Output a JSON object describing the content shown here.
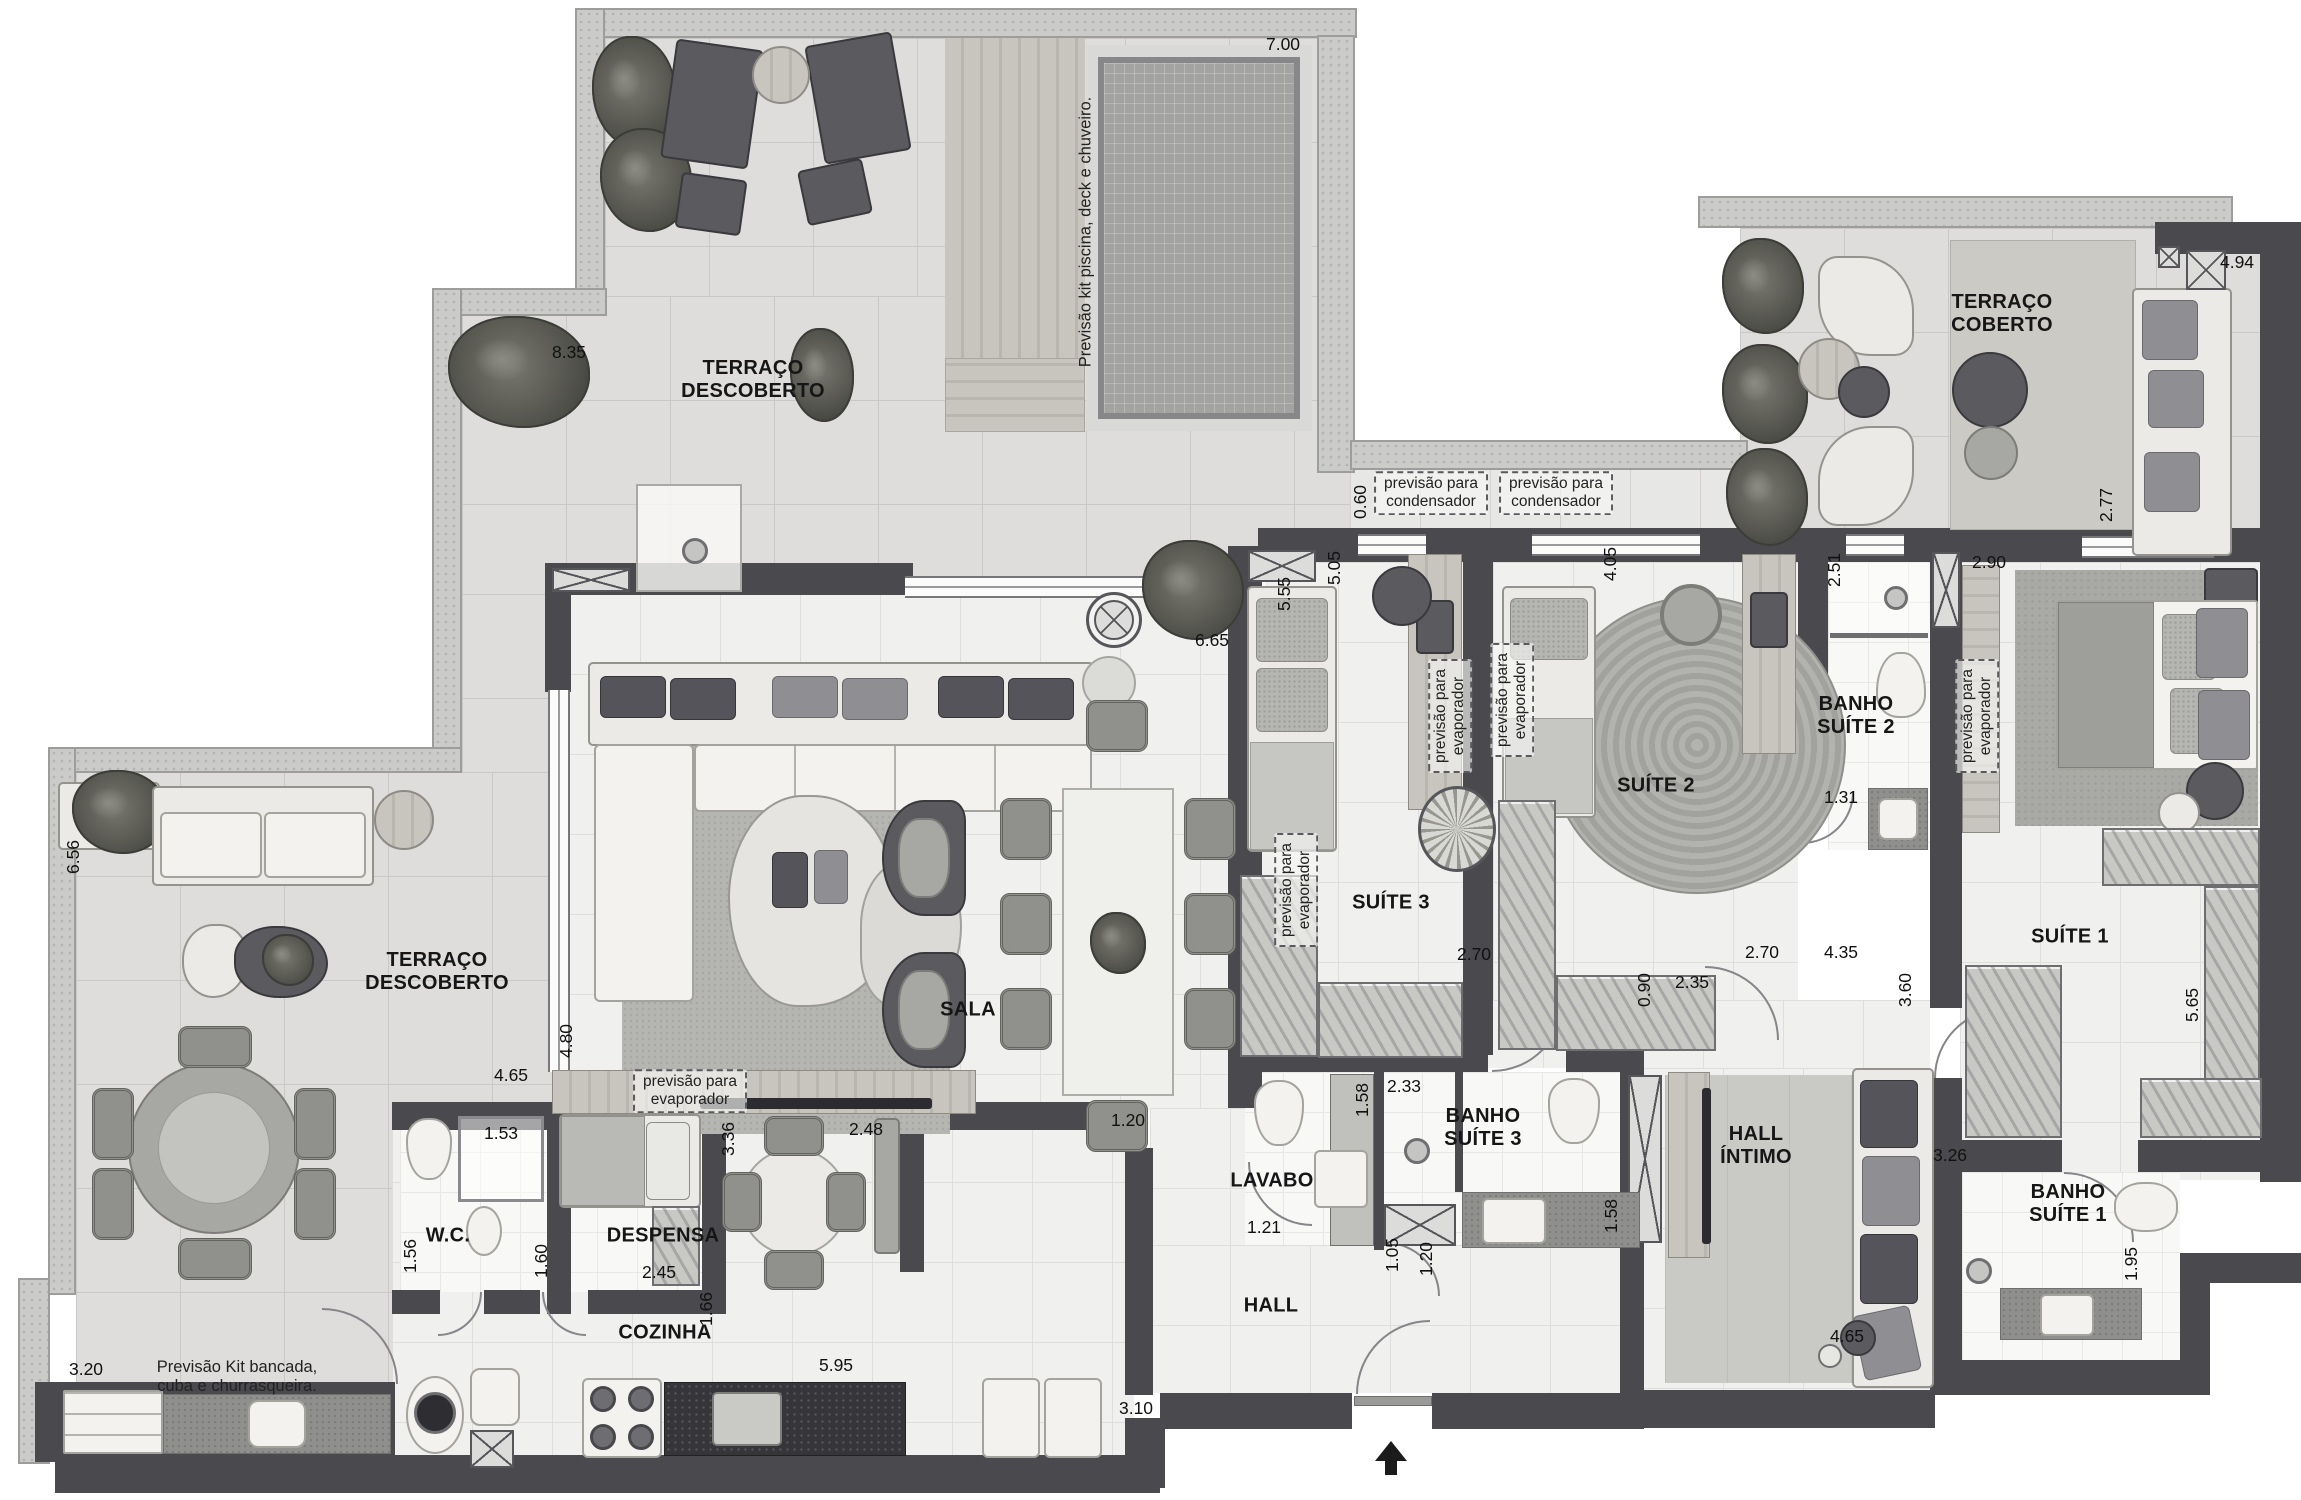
{
  "colors": {
    "wall": "#4a4a4e",
    "floor_tile": "#dedddb",
    "interior_tile": "#f0f0ee",
    "pool_water": "#a3a3a1",
    "annotation_ink": "#222222"
  },
  "floorplan": {
    "room_labels": [
      {
        "name": "room-label-terraco-descoberto-top",
        "text": "TERRAÇO\nDESCOBERTO",
        "x": 753,
        "y": 380
      },
      {
        "name": "room-label-terraco-coberto",
        "text": "TERRAÇO\nCOBERTO",
        "x": 2002,
        "y": 314
      },
      {
        "name": "room-label-terraco-descoberto-left",
        "text": "TERRAÇO\nDESCOBERTO",
        "x": 437,
        "y": 972
      },
      {
        "name": "room-label-sala",
        "text": "SALA",
        "x": 968,
        "y": 1010
      },
      {
        "name": "room-label-cozinha",
        "text": "COZINHA",
        "x": 665,
        "y": 1333
      },
      {
        "name": "room-label-despensa",
        "text": "DESPENSA",
        "x": 663,
        "y": 1236
      },
      {
        "name": "room-label-wc",
        "text": "W.C.",
        "x": 448,
        "y": 1236
      },
      {
        "name": "room-label-lavabo",
        "text": "LAVABO",
        "x": 1272,
        "y": 1181
      },
      {
        "name": "room-label-hall",
        "text": "HALL",
        "x": 1271,
        "y": 1306
      },
      {
        "name": "room-label-hall-intimo",
        "text": "HALL\nÍNTIMO",
        "x": 1756,
        "y": 1146
      },
      {
        "name": "room-label-banho-suite-3",
        "text": "BANHO\nSUÍTE 3",
        "x": 1483,
        "y": 1128
      },
      {
        "name": "room-label-banho-suite-2",
        "text": "BANHO\nSUÍTE 2",
        "x": 1856,
        "y": 716
      },
      {
        "name": "room-label-banho-suite-1",
        "text": "BANHO\nSUÍTE 1",
        "x": 2068,
        "y": 1204
      },
      {
        "name": "room-label-suite-1",
        "text": "SUÍTE 1",
        "x": 2070,
        "y": 937
      },
      {
        "name": "room-label-suite-2",
        "text": "SUÍTE 2",
        "x": 1656,
        "y": 786
      },
      {
        "name": "room-label-suite-3",
        "text": "SUÍTE 3",
        "x": 1391,
        "y": 903
      }
    ],
    "dimensions": [
      {
        "text": "7.00",
        "x": 1283,
        "y": 44,
        "rot": 0
      },
      {
        "text": "8.35",
        "x": 569,
        "y": 352,
        "rot": 0
      },
      {
        "text": "4.94",
        "x": 2237,
        "y": 262,
        "rot": 0
      },
      {
        "text": "2.77",
        "x": 2106,
        "y": 505,
        "rot": -90
      },
      {
        "text": "0.60",
        "x": 1360,
        "y": 502,
        "rot": -90
      },
      {
        "text": "6.56",
        "x": 73,
        "y": 857,
        "rot": -90
      },
      {
        "text": "3.20",
        "x": 86,
        "y": 1369,
        "rot": 0
      },
      {
        "text": "5.55",
        "x": 1284,
        "y": 594,
        "rot": -90
      },
      {
        "text": "6.65",
        "x": 1212,
        "y": 640,
        "rot": 0
      },
      {
        "text": "4.80",
        "x": 566,
        "y": 1041,
        "rot": -90
      },
      {
        "text": "4.65",
        "x": 511,
        "y": 1075,
        "rot": 0
      },
      {
        "text": "5.05",
        "x": 1334,
        "y": 568,
        "rot": -90
      },
      {
        "text": "4.05",
        "x": 1610,
        "y": 564,
        "rot": -90
      },
      {
        "text": "2.51",
        "x": 1834,
        "y": 570,
        "rot": -90
      },
      {
        "text": "2.90",
        "x": 1989,
        "y": 562,
        "rot": 0
      },
      {
        "text": "1.31",
        "x": 1841,
        "y": 797,
        "rot": 0
      },
      {
        "text": "2.70",
        "x": 1474,
        "y": 954,
        "rot": 0
      },
      {
        "text": "2.70",
        "x": 1762,
        "y": 952,
        "rot": 0
      },
      {
        "text": "4.35",
        "x": 1841,
        "y": 952,
        "rot": 0
      },
      {
        "text": "2.35",
        "x": 1692,
        "y": 982,
        "rot": 0
      },
      {
        "text": "0.90",
        "x": 1644,
        "y": 990,
        "rot": -90
      },
      {
        "text": "3.60",
        "x": 1905,
        "y": 990,
        "rot": -90
      },
      {
        "text": "5.65",
        "x": 2192,
        "y": 1005,
        "rot": -90
      },
      {
        "text": "3.26",
        "x": 1950,
        "y": 1155,
        "rot": 0
      },
      {
        "text": "1.95",
        "x": 2131,
        "y": 1264,
        "rot": -90
      },
      {
        "text": "4.65",
        "x": 1847,
        "y": 1336,
        "rot": 0
      },
      {
        "text": "1.58",
        "x": 1362,
        "y": 1100,
        "rot": -90
      },
      {
        "text": "2.33",
        "x": 1404,
        "y": 1086,
        "rot": 0
      },
      {
        "text": "1.58",
        "x": 1611,
        "y": 1216,
        "rot": -90
      },
      {
        "text": "1.21",
        "x": 1264,
        "y": 1227,
        "rot": 0
      },
      {
        "text": "1.05",
        "x": 1392,
        "y": 1255,
        "rot": -90
      },
      {
        "text": "1.20",
        "x": 1426,
        "y": 1259,
        "rot": -90
      },
      {
        "text": "3.10",
        "x": 1136,
        "y": 1408,
        "rot": 0
      },
      {
        "text": "1.20",
        "x": 1128,
        "y": 1120,
        "rot": 0
      },
      {
        "text": "1.53",
        "x": 501,
        "y": 1133,
        "rot": 0
      },
      {
        "text": "1.56",
        "x": 410,
        "y": 1256,
        "rot": -90
      },
      {
        "text": "1.60",
        "x": 541,
        "y": 1261,
        "rot": -90
      },
      {
        "text": "2.45",
        "x": 659,
        "y": 1272,
        "rot": 0
      },
      {
        "text": "3.36",
        "x": 728,
        "y": 1139,
        "rot": -90
      },
      {
        "text": "2.48",
        "x": 866,
        "y": 1129,
        "rot": 0
      },
      {
        "text": "1.66",
        "x": 706,
        "y": 1309,
        "rot": -90
      },
      {
        "text": "5.95",
        "x": 836,
        "y": 1365,
        "rot": 0
      }
    ],
    "annotations": [
      {
        "name": "annotation-condensador-1",
        "text": "previsão para\ncondensador",
        "x": 1431,
        "y": 493,
        "rot": 0
      },
      {
        "name": "annotation-condensador-2",
        "text": "previsão para\ncondensador",
        "x": 1556,
        "y": 493,
        "rot": 0
      },
      {
        "name": "annotation-evaporador-sala",
        "text": "previsão para\nevaporador",
        "x": 690,
        "y": 1091,
        "rot": 0
      },
      {
        "name": "annotation-evaporador-jantar",
        "text": "previsão para\nevaporador",
        "x": 1296,
        "y": 890,
        "rot": -90
      },
      {
        "name": "annotation-evaporador-suite3",
        "text": "previsão para\nevaporador",
        "x": 1450,
        "y": 716,
        "rot": -90
      },
      {
        "name": "annotation-evaporador-suite2",
        "text": "previsão para\nevaporador",
        "x": 1512,
        "y": 700,
        "rot": -90
      },
      {
        "name": "annotation-evaporador-suite1",
        "text": "previsão para\nevaporador",
        "x": 1977,
        "y": 716,
        "rot": -90
      }
    ],
    "notes": [
      {
        "name": "note-piscina",
        "text": "Previsão kit piscina, deck e chuveiro.",
        "x": 1086,
        "y": 232,
        "rot": -90
      },
      {
        "name": "note-churrasqueira",
        "text": "Previsão Kit bancada,\ncuba e churrasqueira.",
        "x": 237,
        "y": 1377,
        "rot": 0
      }
    ],
    "entrance": {
      "symbol": "arrow-up",
      "x": 1391,
      "y": 1455
    }
  }
}
